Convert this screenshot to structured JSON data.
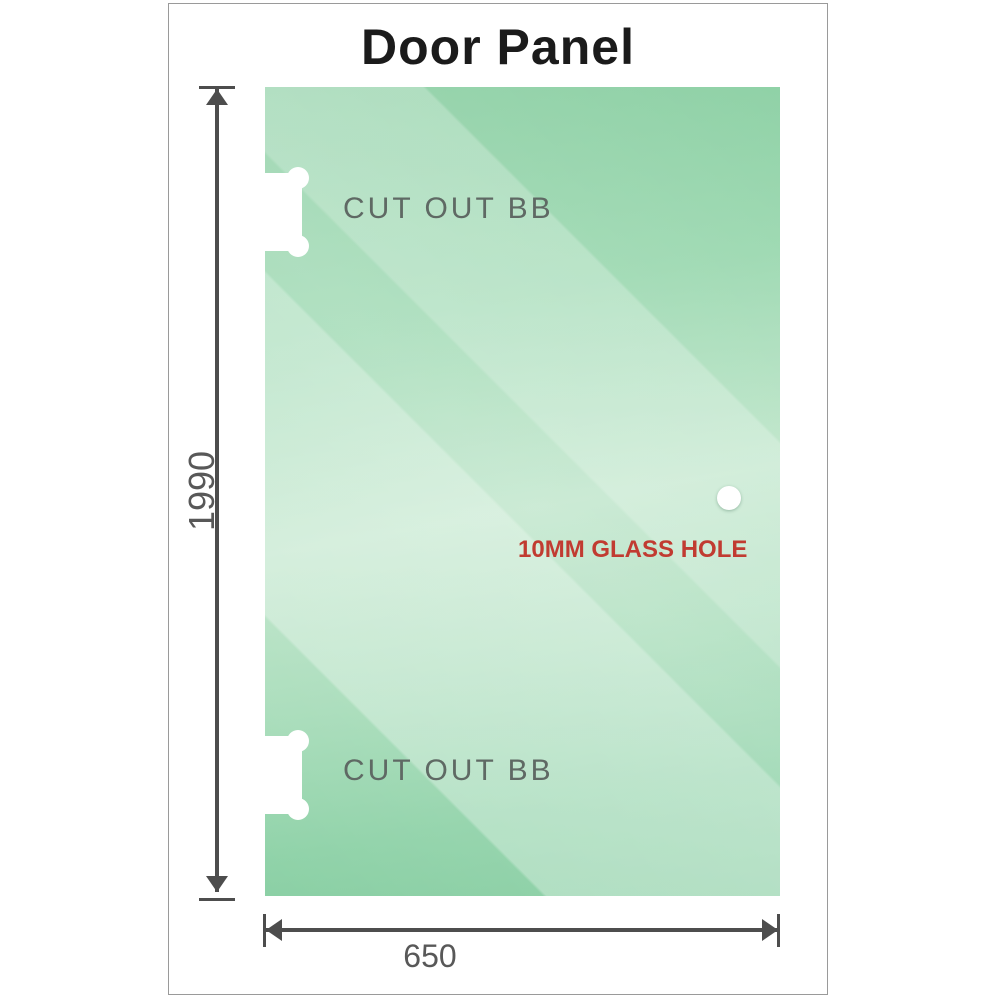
{
  "title": "Door Panel",
  "panel": {
    "top_cutout_label": "CUT OUT BB",
    "bottom_cutout_label": "CUT OUT BB",
    "hole_label": "10MM GLASS HOLE"
  },
  "dimensions": {
    "height_value": "1990",
    "width_value": "650"
  },
  "colors": {
    "glass_green_dark": "#82cb9e",
    "glass_green_mid": "#9bd8b0",
    "glass_green_light": "#cdebd7",
    "cutout_label_gray": "#5f6964",
    "hole_label_red": "#c13b31",
    "dimension_gray": "#4d4d4d",
    "dim_label_gray": "#585858",
    "title_color": "#1b1b1b",
    "frame_border_gray": "#9a9a9a",
    "background": "#ffffff"
  }
}
